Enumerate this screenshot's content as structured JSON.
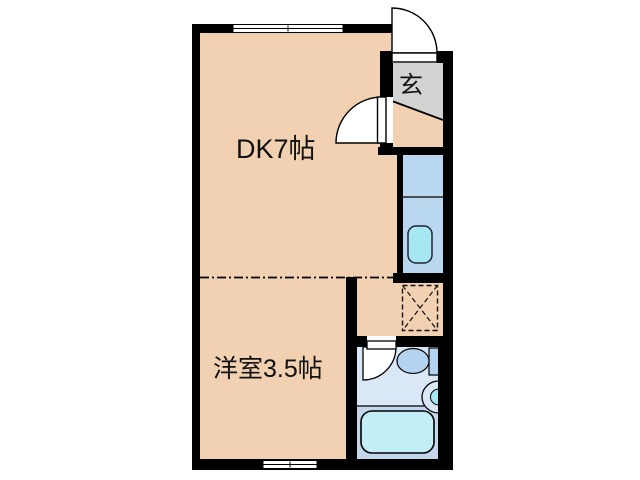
{
  "plan": {
    "rooms": {
      "dk": {
        "label": "DK7帖"
      },
      "western": {
        "label": "洋室3.5帖"
      },
      "entrance": {
        "label": "玄"
      }
    },
    "colors": {
      "wall": "#000000",
      "floor": "#f1d1b1",
      "entrance_floor": "#d3d3d3",
      "washroom_floor": "#b9d7ef",
      "bathroom_floor": "#d9e7f6",
      "bathtub_area_floor": "#c4d7ed",
      "bathtub": "#c3eef8",
      "fixture_cyan": "#a6e7f1",
      "toilet": "#b3d3f0",
      "line": "#1a1a1a"
    }
  }
}
